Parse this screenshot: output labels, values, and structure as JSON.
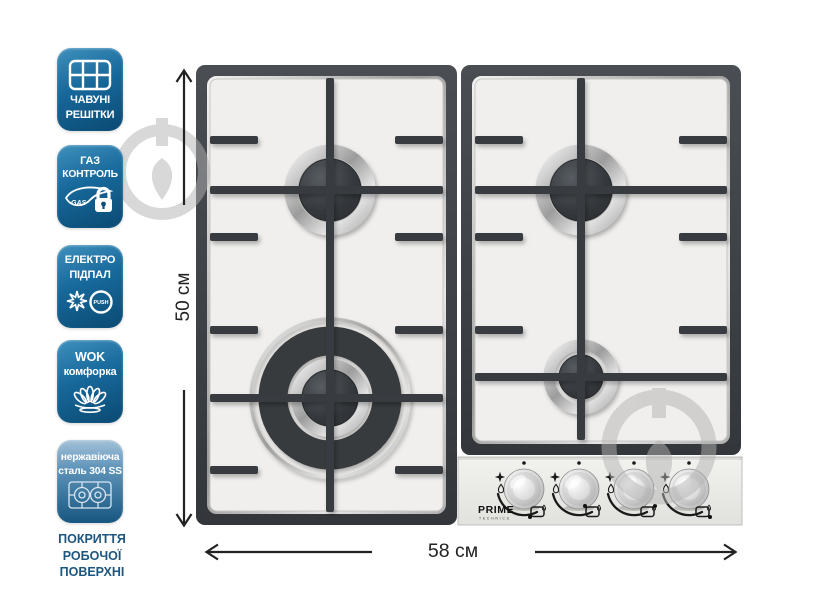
{
  "page": {
    "type": "product-infographic",
    "background": "#ffffff"
  },
  "badges": [
    {
      "name": "cast-iron-grates",
      "label_lines": [
        "ЧАВУНІ",
        "РЕШІТКИ"
      ],
      "icon": "grate-icon"
    },
    {
      "name": "gas-control",
      "label_lines": [
        "ГАЗ",
        "КОНТРОЛЬ"
      ],
      "icon": "gas-lock-icon",
      "icon_text": "GAS"
    },
    {
      "name": "electric-ignition",
      "label_lines": [
        "ЕЛЕКТРО",
        "ПІДПАЛ"
      ],
      "icon": "spark-icon",
      "icon_text": "PUSH"
    },
    {
      "name": "wok-burner",
      "label_lines": [
        "WOK",
        "комфорка"
      ],
      "icon": "wok-flame-icon"
    },
    {
      "name": "stainless-steel-304",
      "label_lines": [
        "нержавіюча",
        "сталь 304 SS"
      ],
      "icon": "stainless-hob-icon"
    }
  ],
  "caption_lines": [
    "ПОКРИТТЯ",
    "РОБОЧОЇ",
    "ПОВЕРХНІ"
  ],
  "dimensions": {
    "height": "50 см",
    "width": "58 см"
  },
  "hob": {
    "brand": "PRIME",
    "brand_sub": "TECHNICS",
    "burners": 4,
    "knobs": 4,
    "wok_burner_position": "front-left",
    "surface": "stainless steel"
  },
  "colors": {
    "badge_top": "#3e90bc",
    "badge_bottom": "#0a4a72",
    "badge5_top": "#a3c1d8",
    "caption_text": "#1d567e",
    "grate": "#383b3f",
    "surface": "#f0efed",
    "panel": "#eaeae7",
    "dimension_text": "#222222",
    "watermark": "#b3b3b3"
  }
}
